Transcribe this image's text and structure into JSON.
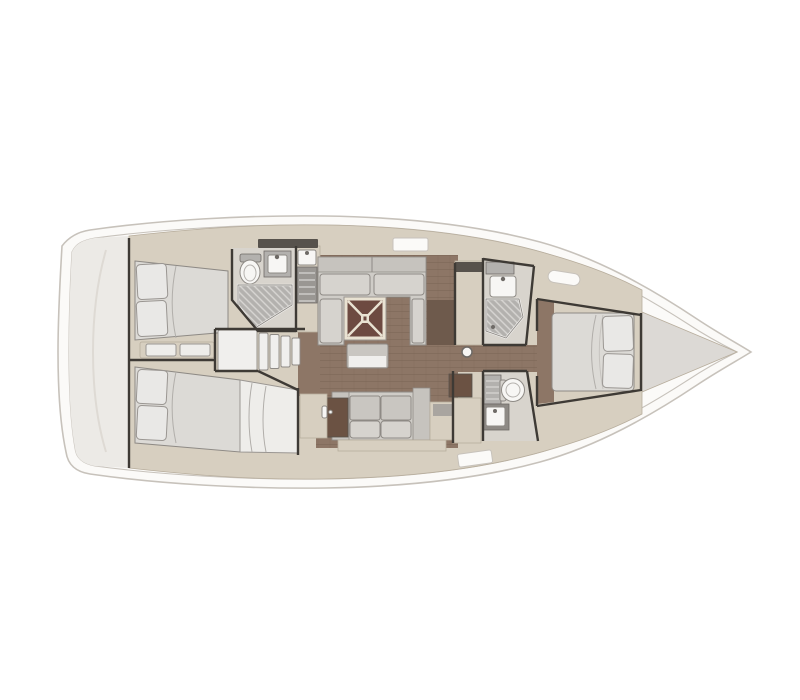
{
  "figure": {
    "type": "sailing-yacht-interior-floor-plan",
    "view": "top-down",
    "bow_direction": "right",
    "background": "#ffffff"
  },
  "areas": [
    {
      "name": "aft-deck"
    },
    {
      "name": "aft-cabin-port"
    },
    {
      "name": "aft-cabin-starboard"
    },
    {
      "name": "companionway-steps"
    },
    {
      "name": "aft-head"
    },
    {
      "name": "galley-unit"
    },
    {
      "name": "salon-u-settee"
    },
    {
      "name": "salon-table"
    },
    {
      "name": "salon-bench"
    },
    {
      "name": "starboard-settee"
    },
    {
      "name": "nav-station"
    },
    {
      "name": "forward-head-port"
    },
    {
      "name": "forward-head-starboard"
    },
    {
      "name": "forward-cabin-island-bed"
    },
    {
      "name": "bow-locker"
    },
    {
      "name": "mast-post"
    }
  ],
  "palette": {
    "background": "#ffffff",
    "hull": "#fbfaf8",
    "hull_line": "#c7c2bb",
    "deck": "#eceae6",
    "cabinet": "#d7cfc0",
    "cabinet_line": "#b7ad9c",
    "cabinet_dark": "#a9a5a0",
    "floor": "#8d7666",
    "floor_dark": "#6e5a4c",
    "door_wood": "#6b5243",
    "hatch_dark": "#57524c",
    "wall": "#3e3a35",
    "sofa": "#cfccc7",
    "sofa_back": "#c6c3be",
    "cushion": "#d6d3ce",
    "bench": "#c9c6c1",
    "bed": "#dcdad6",
    "pillow": "#e9e8e6",
    "pillow_line": "#9a9692",
    "blanket": "#eeedea",
    "fixture": "#f7f6f4",
    "fixture_line": "#8e8a85",
    "fixture_inner": "#b5b2ae",
    "metal": "#6e6a66",
    "seam": "#b1aeaa",
    "head_floor": "#d8d4cd",
    "stove": "#9a9793",
    "shower": "#b3b1ae",
    "shower_line": "#d8d6d3",
    "steps": "#f0efed",
    "table": "#6d4a41",
    "table_trim": "#e9e2d2",
    "bow": "#dcd9d5"
  }
}
